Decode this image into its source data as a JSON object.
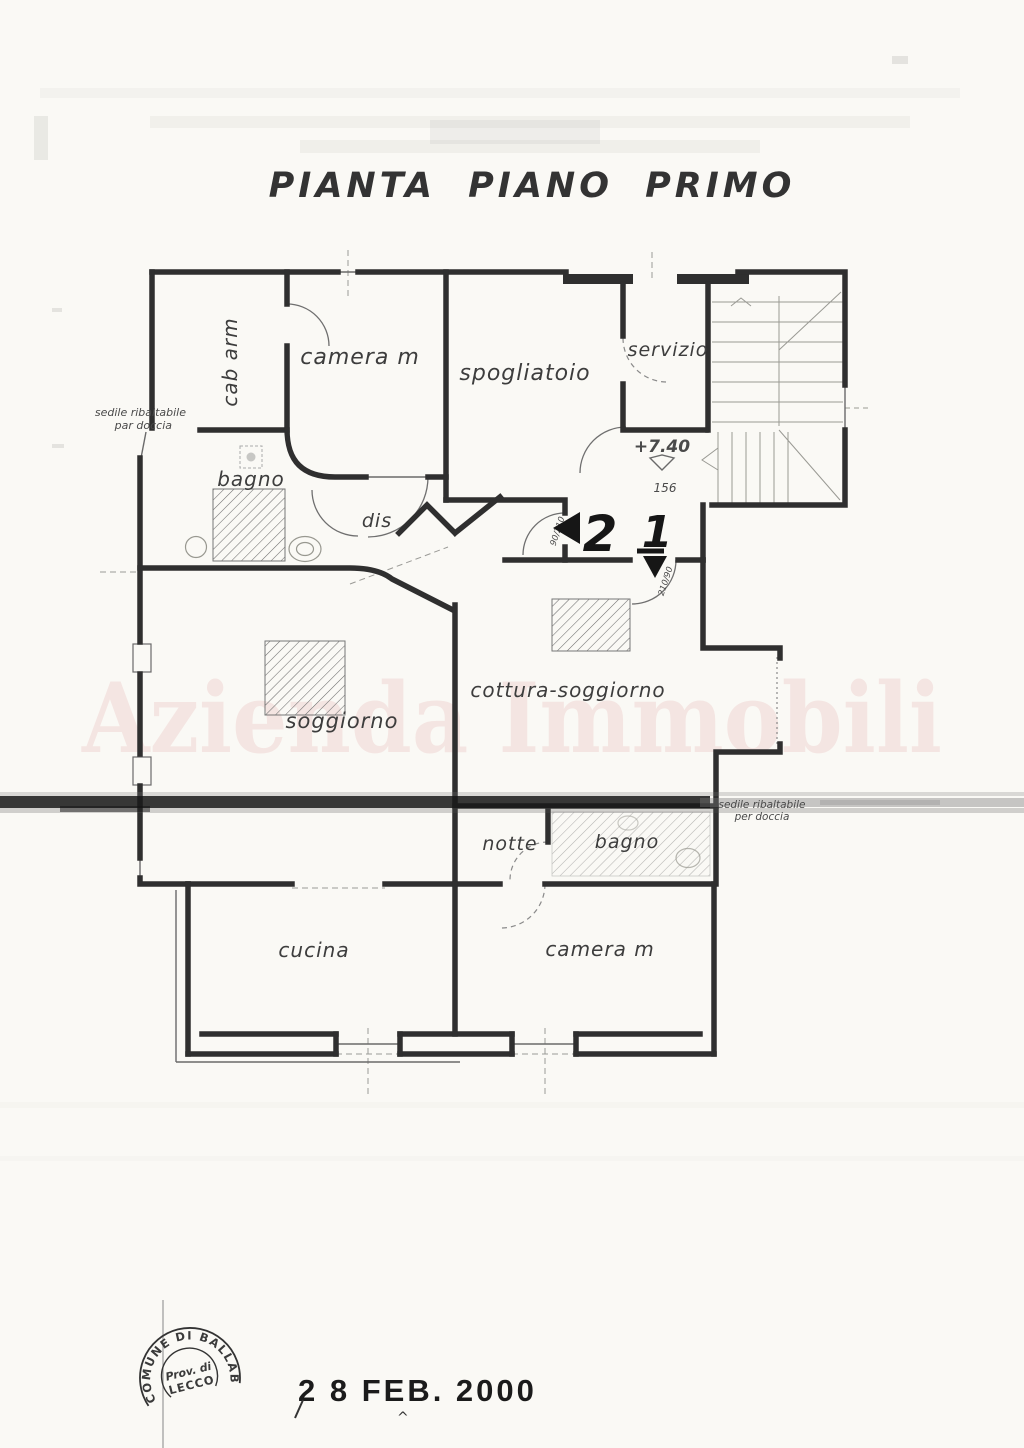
{
  "page": {
    "title": "PIANTA PIANO PRIMO"
  },
  "watermark": {
    "text": "Azienda Immobili"
  },
  "rooms": {
    "cab_arm": "cab arm",
    "camera_top": "camera m",
    "spogliatoio": "spogliatoio",
    "servizio": "servizio",
    "bagno_top": "bagno",
    "dis": "dis",
    "soggiorno": "soggiorno",
    "cottura": "cottura-soggiorno",
    "notte": "notte",
    "bagno_mid": "bagno",
    "cucina": "cucina",
    "camera_bottom": "camera m"
  },
  "notes": {
    "sedile_top_line1": "sedile ribaltabile",
    "sedile_top_line2": "par doccia",
    "sedile_mid_line1": "sedile ribaltabile",
    "sedile_mid_line2": "per doccia"
  },
  "dims": {
    "elevation": "+7.40",
    "level_dim": "156",
    "door_size_left": "90/210",
    "door_size_right": "210/90"
  },
  "marks": {
    "left_number": "2",
    "right_number": "1"
  },
  "stamp": {
    "ring_text": "COMUNE DI BALLABIO",
    "line1": "Prov. di",
    "line2": "LECCO"
  },
  "date_stamp": {
    "text": "2 8 FEB. 2000"
  },
  "colors": {
    "ink": "#2f2f2f",
    "paper": "#faf9f5",
    "watermark_pink": "#f0d6d3",
    "band": "#1a1a1a"
  }
}
